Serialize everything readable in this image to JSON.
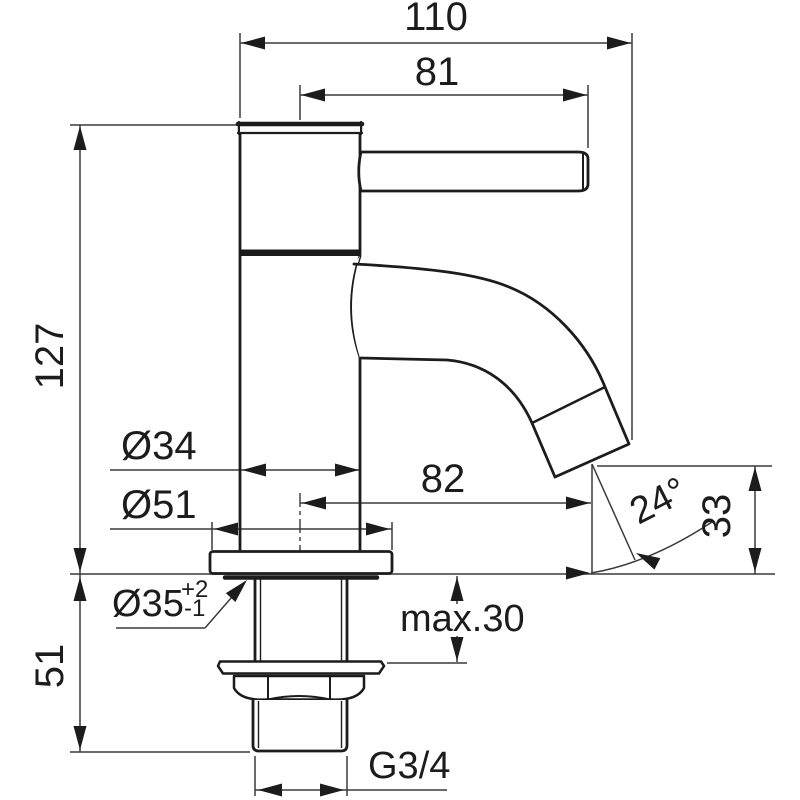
{
  "page": {
    "background": "#ffffff",
    "description": "Technical dimension drawing of a single-lever pillar tap (side elevation)"
  },
  "drawing": {
    "line_color": "#1c1c1c",
    "dim_color": "#3a3a3a",
    "dimensions": {
      "overall_width": "110",
      "handle_reach": "81",
      "height_above_deck": "127",
      "body_diameter": "Ø34",
      "base_diameter": "Ø51",
      "spout_reach": "82",
      "outlet_angle": "24°",
      "outlet_height": "33",
      "max_deck_thickness": "max.30",
      "hole_diameter": "Ø35",
      "hole_tolerance_upper": "+2",
      "hole_tolerance_lower": "-1",
      "shank_length": "51",
      "thread_size": "G3/4"
    }
  }
}
